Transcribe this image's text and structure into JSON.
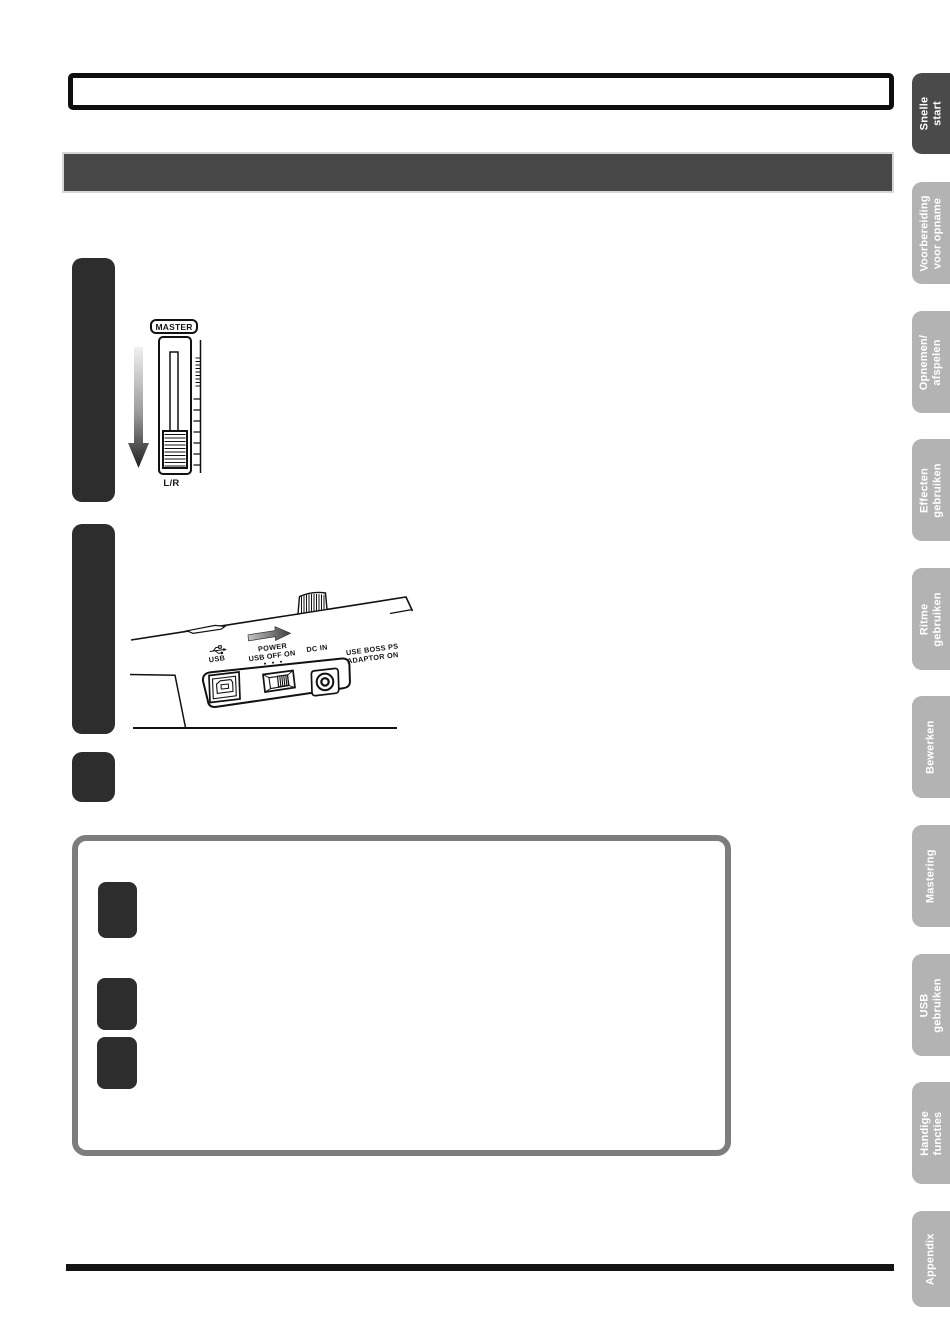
{
  "sidebar": {
    "active_color": "#4a4a4a",
    "inactive_color": "#b3b3b3",
    "text_color": "#ffffff",
    "tabs": [
      {
        "label": "Snelle start",
        "active": true
      },
      {
        "label": "Voorbereiding\nvoor opname",
        "active": false
      },
      {
        "label": "Opnemen/\nafspelen",
        "active": false
      },
      {
        "label": "Effecten\ngebruiken",
        "active": false
      },
      {
        "label": "Ritme\ngebruiken",
        "active": false
      },
      {
        "label": "Bewerken",
        "active": false
      },
      {
        "label": "Mastering",
        "active": false
      },
      {
        "label": "USB\ngebruiken",
        "active": false
      },
      {
        "label": "Handige\nfuncties",
        "active": false
      },
      {
        "label": "Appendix",
        "active": false
      }
    ]
  },
  "fader": {
    "master_label": "MASTER",
    "channel_label": "L/R"
  },
  "backpanel": {
    "usb_label": "USB",
    "power_label": "POWER",
    "switch_scale_label": "USB OFF ON",
    "dc_in_label": "DC IN",
    "adaptor_warning_line1": "USE BOSS PS",
    "adaptor_warning_line2": "ADAPTOR ON"
  },
  "colors": {
    "header_bar": "#474747",
    "step_block": "#2d2d2d",
    "note_box_border": "#7d7d7d",
    "title_box_border": "#0e0e0e"
  }
}
